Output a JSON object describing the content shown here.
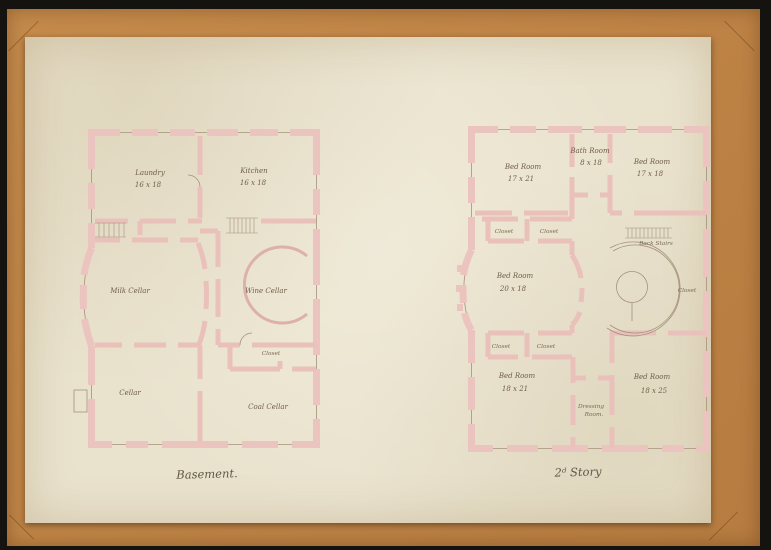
{
  "drawing": {
    "captions": {
      "basement": "Basement.",
      "second_story": "2ᵈ Story"
    },
    "basement": {
      "rooms": {
        "laundry": {
          "name": "Laundry",
          "size": "16 x 18"
        },
        "kitchen": {
          "name": "Kitchen",
          "size": "16 x 18"
        },
        "milk_cellar": {
          "name": "Milk Cellar"
        },
        "wine_cellar": {
          "name": "Wine Cellar"
        },
        "closet": {
          "name": "Closet"
        },
        "cellar": {
          "name": "Cellar"
        },
        "coal_cellar": {
          "name": "Coal Cellar"
        }
      }
    },
    "second_story": {
      "rooms": {
        "bed_nw": {
          "name": "Bed Room",
          "size": "17 x 21"
        },
        "bath": {
          "name": "Bath Room",
          "size": "8 x 18"
        },
        "bed_ne": {
          "name": "Bed Room",
          "size": "17 x 18"
        },
        "closet_n1": {
          "name": "Closet"
        },
        "closet_n2": {
          "name": "Closet"
        },
        "back_stairs": {
          "name": "Back Stairs"
        },
        "bed_w": {
          "name": "Bed Room",
          "size": "20 x 18"
        },
        "closet_e": {
          "name": "Closet"
        },
        "closet_s1": {
          "name": "Closet"
        },
        "closet_s2": {
          "name": "Closet"
        },
        "bed_sw": {
          "name": "Bed Room",
          "size": "18 x 21"
        },
        "dressing": {
          "line1": "Dressing",
          "line2": "Room."
        },
        "bed_se": {
          "name": "Bed Room",
          "size": "18 x 25"
        }
      }
    },
    "colors": {
      "mat": "#bf8446",
      "frame": "#15130f",
      "paper": "#e9e2cd",
      "wall_wash": "#ecc4bf",
      "ink": "#6f5e47"
    }
  }
}
